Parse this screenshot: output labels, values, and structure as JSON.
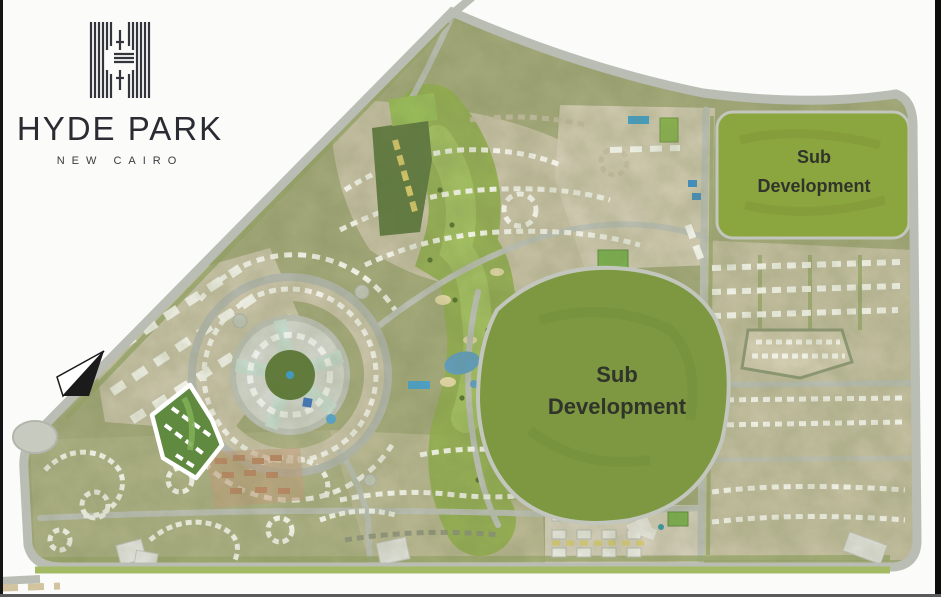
{
  "brand": {
    "name": "HYDE PARK",
    "location": "NEW CAIRO"
  },
  "map": {
    "labels": {
      "sub_development_center_line1": "Sub",
      "sub_development_center_line2": "Development",
      "sub_development_ne_line1": "Sub",
      "sub_development_ne_line2": "Development"
    },
    "icons": {
      "north_arrow": "north-arrow-icon",
      "logo_mark": "hyde-park-monogram"
    },
    "colors": {
      "background": "#fbfbf9",
      "boundary_road": "#b9bdb4",
      "site_base": "#a6ab7c",
      "cluster_beige": "#d2cab1",
      "parkland_green": "#93b050",
      "sub_development_green": "#7d9840",
      "sub_development_ne_green": "#8ca63f",
      "water_blue": "#57a0c8",
      "label_text": "#30342a",
      "logo_ink": "#2b2b33"
    }
  }
}
